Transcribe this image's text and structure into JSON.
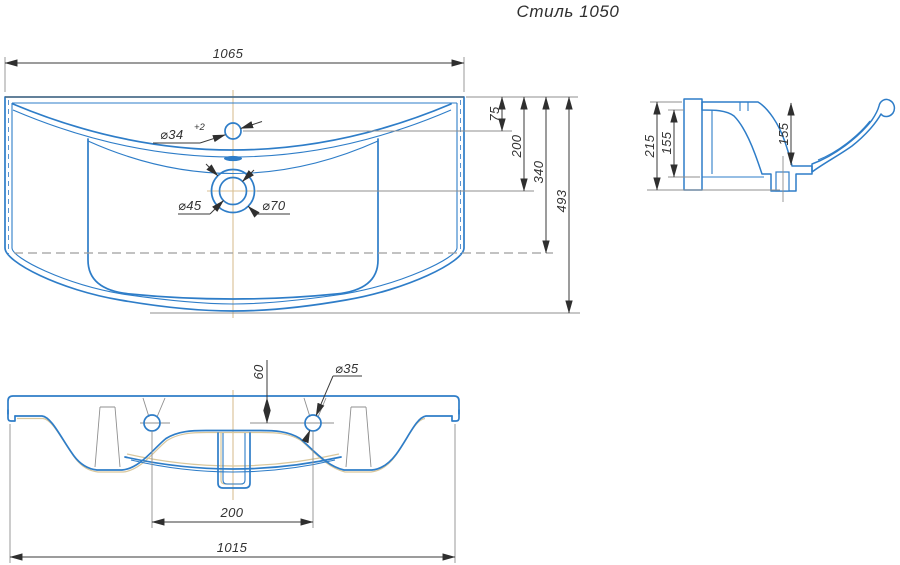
{
  "title": "Стиль 1050",
  "colors": {
    "outline_blue": "#2e7dc8",
    "dark_edge": "#4d6f8c",
    "dimension": "#3a3a3a",
    "extension": "#8f8f8f",
    "centerline_tan": "#d8bf93",
    "section_dash": "#9e9e9e"
  },
  "views": {
    "plan": {
      "dims": {
        "overall_width": "1065",
        "faucet_offset": "75",
        "drain_offset": "200",
        "mid_depth": "340",
        "overall_depth": "493",
        "faucet_hole_dia": "⌀34",
        "faucet_hole_tol": "+2",
        "drain_dia_inner": "⌀45",
        "drain_dia_outer": "⌀70"
      }
    },
    "section": {
      "dims": {
        "overall_height": "215",
        "back_wall_height": "155",
        "bowl_depth": "155"
      }
    },
    "front": {
      "dims": {
        "hole_drop": "60",
        "mount_hole_dia": "⌀35",
        "hole_spacing": "200",
        "bottom_width": "1015"
      }
    }
  }
}
